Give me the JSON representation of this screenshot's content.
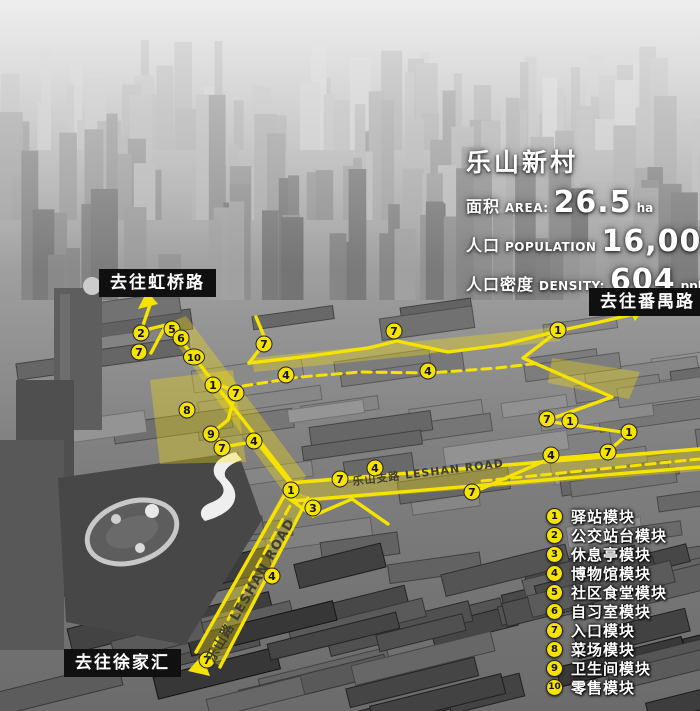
{
  "info_panel": {
    "title": "乐山新村",
    "stats": [
      {
        "label_cn": "面积",
        "label_en": "AREA:",
        "value": "26.5",
        "unit": "ha"
      },
      {
        "label_cn": "人口",
        "label_en": "POPULATION",
        "value": "16,000",
        "unit": "ppl"
      },
      {
        "label_cn": "人口密度",
        "label_en": "DENSITY:",
        "value": "604",
        "unit": "ppl/ha"
      }
    ]
  },
  "direction_labels": [
    {
      "id": "hongqiao-road",
      "text": "去往虹桥路"
    },
    {
      "id": "panyu-road",
      "text": "去往番禺路"
    },
    {
      "id": "xujiahui",
      "text": "去往徐家汇"
    }
  ],
  "road_labels": [
    {
      "id": "leshan-road",
      "text": "乐山路 LESHAN ROAD"
    },
    {
      "id": "leshan-branch-road",
      "text": "乐山支路 LESHAN ROAD"
    }
  ],
  "legend": {
    "items": [
      {
        "num": "1",
        "label": "驿站模块"
      },
      {
        "num": "2",
        "label": "公交站台模块"
      },
      {
        "num": "3",
        "label": "休息亭模块"
      },
      {
        "num": "4",
        "label": "博物馆模块"
      },
      {
        "num": "5",
        "label": "社区食堂模块"
      },
      {
        "num": "6",
        "label": "自习室模块"
      },
      {
        "num": "7",
        "label": "入口模块"
      },
      {
        "num": "8",
        "label": "菜场模块"
      },
      {
        "num": "9",
        "label": "卫生间模块"
      },
      {
        "num": "10",
        "label": "零售模块"
      }
    ]
  },
  "map_markers": [
    {
      "num": "2",
      "x": 141,
      "y": 333
    },
    {
      "num": "5",
      "x": 172,
      "y": 329
    },
    {
      "num": "6",
      "x": 181,
      "y": 338
    },
    {
      "num": "7",
      "x": 139,
      "y": 352
    },
    {
      "num": "10",
      "x": 194,
      "y": 357
    },
    {
      "num": "1",
      "x": 213,
      "y": 385
    },
    {
      "num": "7",
      "x": 236,
      "y": 393
    },
    {
      "num": "8",
      "x": 187,
      "y": 410
    },
    {
      "num": "9",
      "x": 211,
      "y": 434
    },
    {
      "num": "7",
      "x": 222,
      "y": 448
    },
    {
      "num": "4",
      "x": 254,
      "y": 441
    },
    {
      "num": "7",
      "x": 264,
      "y": 344
    },
    {
      "num": "4",
      "x": 286,
      "y": 375
    },
    {
      "num": "7",
      "x": 394,
      "y": 331
    },
    {
      "num": "4",
      "x": 428,
      "y": 371
    },
    {
      "num": "1",
      "x": 291,
      "y": 490
    },
    {
      "num": "3",
      "x": 313,
      "y": 508
    },
    {
      "num": "7",
      "x": 340,
      "y": 479
    },
    {
      "num": "4",
      "x": 375,
      "y": 468
    },
    {
      "num": "7",
      "x": 472,
      "y": 492
    },
    {
      "num": "4",
      "x": 272,
      "y": 576
    },
    {
      "num": "7",
      "x": 207,
      "y": 660
    },
    {
      "num": "1",
      "x": 558,
      "y": 330
    },
    {
      "num": "7",
      "x": 547,
      "y": 419
    },
    {
      "num": "1",
      "x": 570,
      "y": 421
    },
    {
      "num": "1",
      "x": 629,
      "y": 432
    },
    {
      "num": "7",
      "x": 608,
      "y": 452
    },
    {
      "num": "4",
      "x": 551,
      "y": 455
    }
  ],
  "colors": {
    "route": "#f6e400",
    "label_bg": "#101010",
    "marker_text": "#111111"
  }
}
